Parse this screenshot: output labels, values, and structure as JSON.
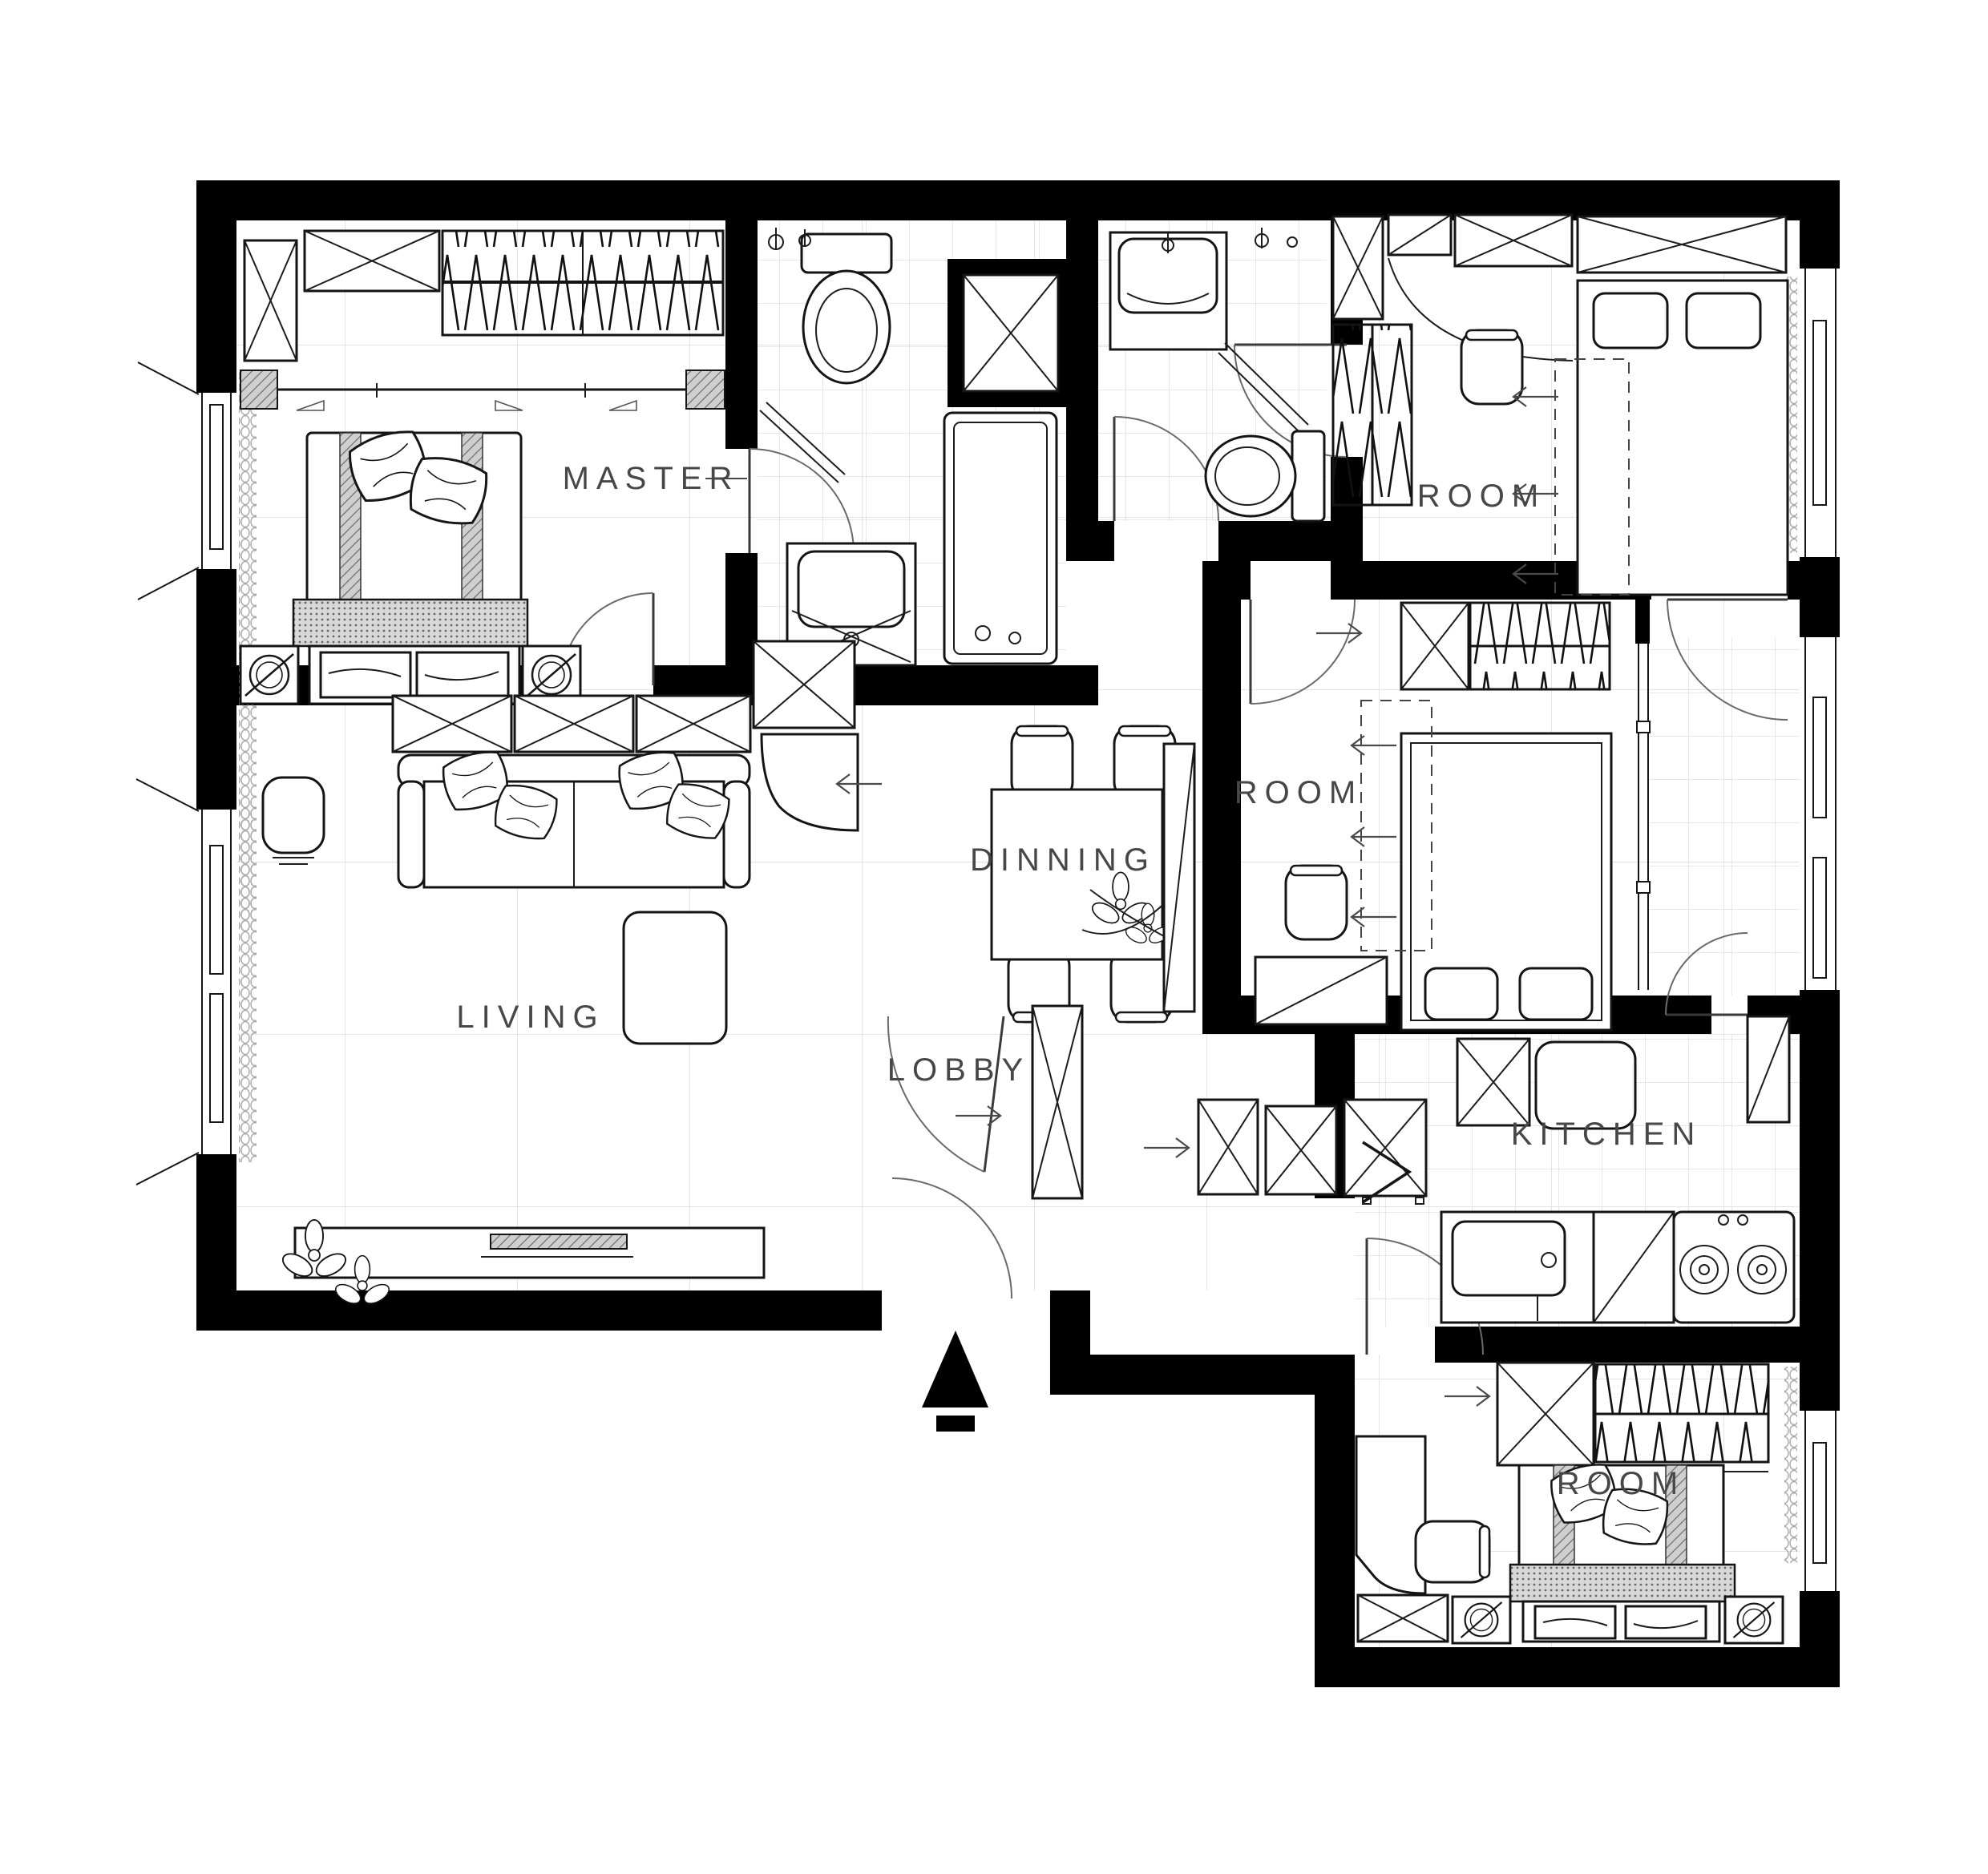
{
  "plan": {
    "type": "apartment-floor-plan",
    "rooms": [
      {
        "id": "master",
        "label": "MASTER"
      },
      {
        "id": "room-top-right",
        "label": "ROOM"
      },
      {
        "id": "room-middle",
        "label": "ROOM"
      },
      {
        "id": "dining",
        "label": "DINNING"
      },
      {
        "id": "living",
        "label": "LIVING"
      },
      {
        "id": "lobby",
        "label": "LOBBY"
      },
      {
        "id": "kitchen",
        "label": "KITCHEN"
      },
      {
        "id": "room-bottom",
        "label": "ROOM"
      }
    ],
    "furniture_icons": {
      "master": [
        "double-bed",
        "pillows",
        "wardrobe-hangers",
        "storage-xbox",
        "nightstand-lamp",
        "bench-cushions",
        "curtain-rail"
      ],
      "master-bath": [
        "toilet",
        "vanity-sink",
        "bathtub",
        "shower-partition",
        "duct-shaft-xbox",
        "faucet"
      ],
      "second-bath": [
        "vanity-sink",
        "toilet",
        "shower-partition",
        "faucet"
      ],
      "room-top-right": [
        "single-bed",
        "pillows",
        "wardrobe-hangers",
        "storage-xbox",
        "desk-chair",
        "curtain"
      ],
      "room-middle": [
        "double-bed",
        "pillows",
        "wardrobe-hangers",
        "duct-shaft-xbox",
        "desk",
        "desk-chair",
        "window-curtain"
      ],
      "dining": [
        "dining-table",
        "dining-chair",
        "dining-chair",
        "dining-chair",
        "dining-chair",
        "flower-centerpiece",
        "tall-cabinet"
      ],
      "living": [
        "sofa",
        "throw-pillows",
        "coffee-table",
        "stool",
        "tv-console",
        "plant-flowers",
        "storage-xbox-row"
      ],
      "lobby": [
        "shoe-cabinet",
        "entry-door",
        "direction-arrow"
      ],
      "kitchen": [
        "kitchen-sink",
        "gas-cooktop",
        "counter-cabinet",
        "tall-cabinet",
        "storage-xbox"
      ],
      "room-bottom": [
        "double-bed",
        "pillows",
        "wardrobe-hangers",
        "storage-xbox",
        "desk",
        "desk-chair",
        "nightstand-lamp",
        "bench-cushions"
      ],
      "balcony": [
        "tiled-floor",
        "swing-door"
      ]
    },
    "markers": {
      "entry-arrow": "solid triangle pointing up at main entrance",
      "slide-arrows": "small open arrows indicating closet/slide direction"
    },
    "colors": {
      "wall": "#000000",
      "floor": "#ffffff",
      "grid_large": "#e4e4e4",
      "grid_small": "#dfdfdf",
      "furniture_line": "#161616",
      "door_arc": "#6a6a6a",
      "label_text": "#474747",
      "hatch_fill": "#9a9a9a"
    }
  }
}
